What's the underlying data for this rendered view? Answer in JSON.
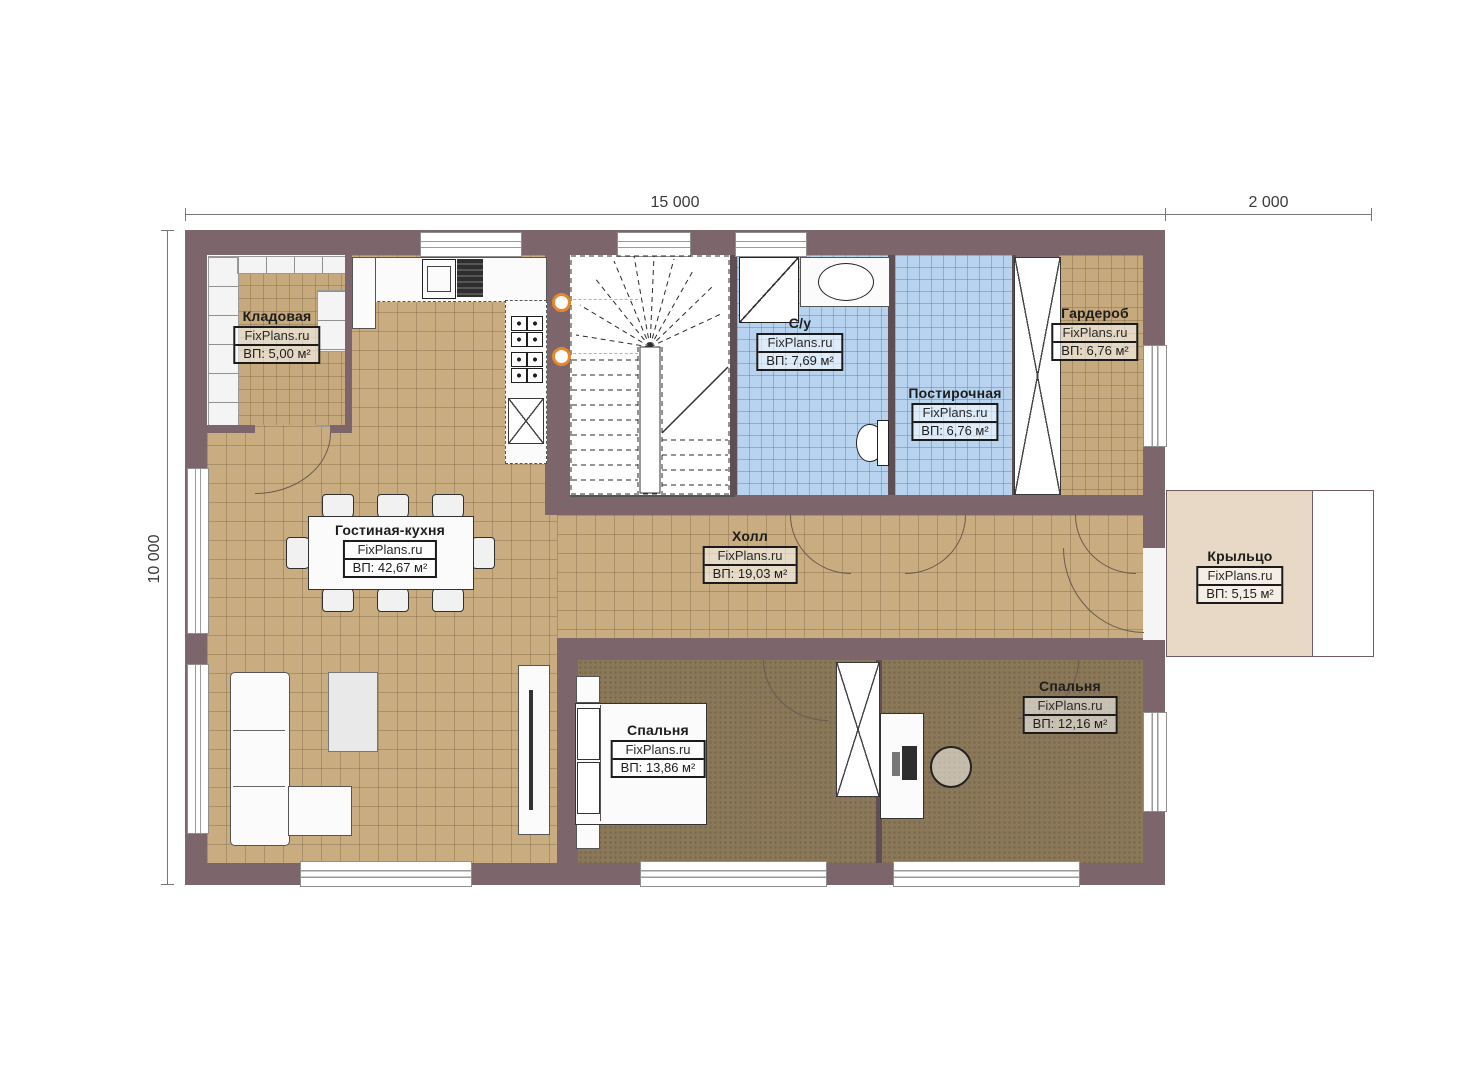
{
  "watermark": "FixPlans.ru",
  "dimensions": {
    "top_main": "15 000",
    "top_right": "2 000",
    "left": "10 000"
  },
  "rooms": [
    {
      "id": "pantry",
      "name": "Кладовая",
      "area": "ВП: 5,00 м²"
    },
    {
      "id": "bathroom",
      "name": "С/у",
      "area": "ВП: 7,69 м²"
    },
    {
      "id": "laundry",
      "name": "Постирочная",
      "area": "ВП: 6,76 м²"
    },
    {
      "id": "wardrobe",
      "name": "Гардероб",
      "area": "ВП: 6,76 м²"
    },
    {
      "id": "living",
      "name": "Гостиная-кухня",
      "area": "ВП: 42,67 м²"
    },
    {
      "id": "hall",
      "name": "Холл",
      "area": "ВП: 19,03 м²"
    },
    {
      "id": "porch",
      "name": "Крыльцо",
      "area": "ВП: 5,15 м²"
    },
    {
      "id": "bedroom1",
      "name": "Спальня",
      "area": "ВП: 13,86 м²"
    },
    {
      "id": "bedroom2",
      "name": "Спальня",
      "area": "ВП: 12,16 м²"
    }
  ],
  "colors": {
    "wall": "#7d666b",
    "tile_tan": "#c9ad80",
    "tile_blue": "#b7d3ef",
    "floor_dark": "#8b7859",
    "porch": "#e7d9c5",
    "accent_lamp": "#e8862a"
  }
}
